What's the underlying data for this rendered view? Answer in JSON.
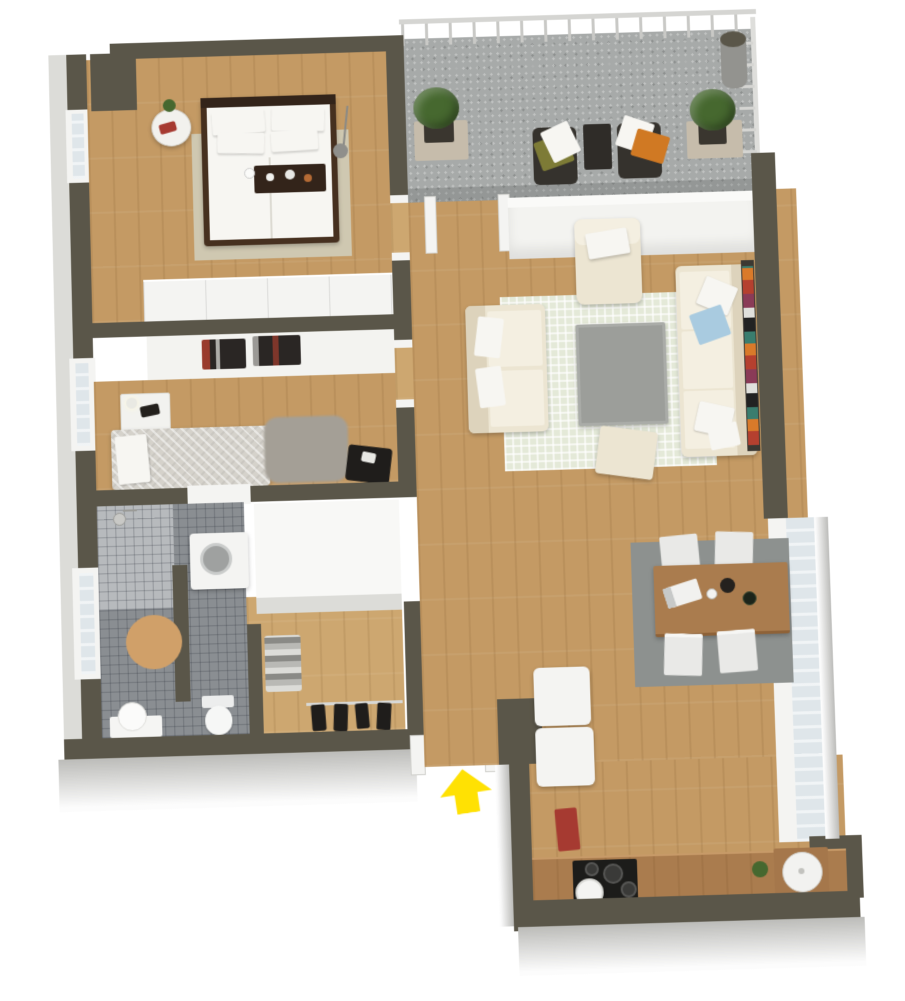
{
  "figure": {
    "kind": "3d-isometric-floor-plan",
    "style": "top-down 3D render, one-floor apartment, no text labels",
    "entrance_marker": "yellow up-arrow at stair entrance"
  },
  "floorplan": {
    "rooms": [
      {
        "name": "bedroom-1",
        "position": "top-left",
        "furniture": [
          "double-bed-dark-frame-white-duvet",
          "four-white-pillows",
          "dark-breakfast-tray",
          "round-side-table",
          "red-magazine",
          "small-plant",
          "floor-lamp",
          "beige-rug",
          "white-wardrobe-row",
          "window-west"
        ]
      },
      {
        "name": "bedroom-2",
        "position": "middle-left",
        "furniture": [
          "bed-gray-duvet",
          "white-pillow",
          "white-nightstand",
          "lamp",
          "dark-book",
          "gray-shag-rug",
          "chair-with-dark-clothes",
          "two-wall-posters",
          "window-west"
        ]
      },
      {
        "name": "bathroom",
        "position": "bottom-left",
        "furniture": [
          "shower-corner",
          "shower-head",
          "washing-machine",
          "round-tan-rug",
          "toilet",
          "washbasin",
          "window-west",
          "gray-tile-floor"
        ]
      },
      {
        "name": "hallway",
        "position": "center",
        "furniture": [
          "white-wardrobes",
          "folded-clothes-shelf",
          "coat-rail-with-dark-garments",
          "staircase-dark-treads",
          "entry-door",
          "yellow-entrance-arrow",
          "wood-slat-radiator",
          "umbrella-stand"
        ]
      },
      {
        "name": "living-room",
        "position": "right",
        "furniture": [
          "three-seat-cream-sofa",
          "two-seat-cream-loveseat",
          "cream-armchair",
          "gray-coffee-table",
          "cream-ottoman",
          "pale-checkered-rug",
          "blue-pillow",
          "white-pillows",
          "bookshelf-colorful",
          "dark-door-leaf"
        ]
      },
      {
        "name": "dining-area",
        "position": "right-lower",
        "furniture": [
          "wood-dining-table",
          "four-white-chairs",
          "laptop",
          "carafe-and-bottles",
          "gray-rug",
          "tall-east-window"
        ]
      },
      {
        "name": "kitchen",
        "position": "bottom-right",
        "furniture": [
          "wood-counter",
          "black-cooktop-four-burners",
          "white-pot",
          "round-sink-on-board",
          "green-plant",
          "red-bin",
          "two-white-appliance-cabinets"
        ]
      },
      {
        "name": "balcony",
        "position": "top-right",
        "furniture": [
          "white-railing",
          "two-dark-wicker-chairs",
          "green-cushion",
          "orange-cushion",
          "white-pillows",
          "dark-side-table",
          "two-planter-boxes",
          "chimney-pipe",
          "speckled-concrete-floor"
        ]
      }
    ]
  },
  "colors": {
    "wall_top": "#5a5649",
    "wall_face": "#f3f3f0",
    "wall_face_shade": "#dcdcd8",
    "exterior_face": "#bcbcb9",
    "wood": "#c49a64",
    "wood_light": "#cda770",
    "balcony_floor": "#a7aaa9",
    "tile": "#8a8e92",
    "tile_light": "#b7babd",
    "rug_bed1": "#cfc8b1",
    "rug_bed2": "#a49f96",
    "rug_living": "#e4e9d8",
    "rug_dining": "#8d918f",
    "rug_bath": "#d0a069",
    "cream": "#ece5d2",
    "cream_light": "#f4efe1",
    "cream_shade": "#ddd3bc",
    "dark_wood": "#46301f",
    "darker_wood": "#33241a",
    "white_soft": "#f7f6f2",
    "gray_table": "#9c9e9a",
    "dining_wood": "#aa7c4e",
    "chair_white": "#e9e9e7",
    "wicker": "#35322d",
    "cushion_green": "#7d7b36",
    "cushion_orange": "#d07923",
    "pillow_blue": "#a9cbe0",
    "stair_dark": "#4f4c48",
    "stair_light": "#cfcfcd",
    "landing": "#d8d8d6",
    "arrow_yellow": "#ffe103",
    "red_accent": "#a63a31",
    "plant_green": "#46682f",
    "planter": "#3a362f",
    "mat_tan": "#c6bcab",
    "chimney": "#93938f",
    "glass": "#dfe6ea",
    "window_frame": "#f4f4f2",
    "appliance_white": "#f4f4f2",
    "machine_door": "#9fa1a0",
    "cooktop": "#1c1c1a",
    "dark_cloth": "#1f1d1b",
    "rail": "#d8d8d5",
    "poster_dark": "#2a2624",
    "duvet_gray": "#d5d2cb",
    "book_colors": [
      "#b5402f",
      "#d97a2a",
      "#3a7d6e",
      "#222222",
      "#e0e0dc",
      "#8a3b57"
    ]
  }
}
